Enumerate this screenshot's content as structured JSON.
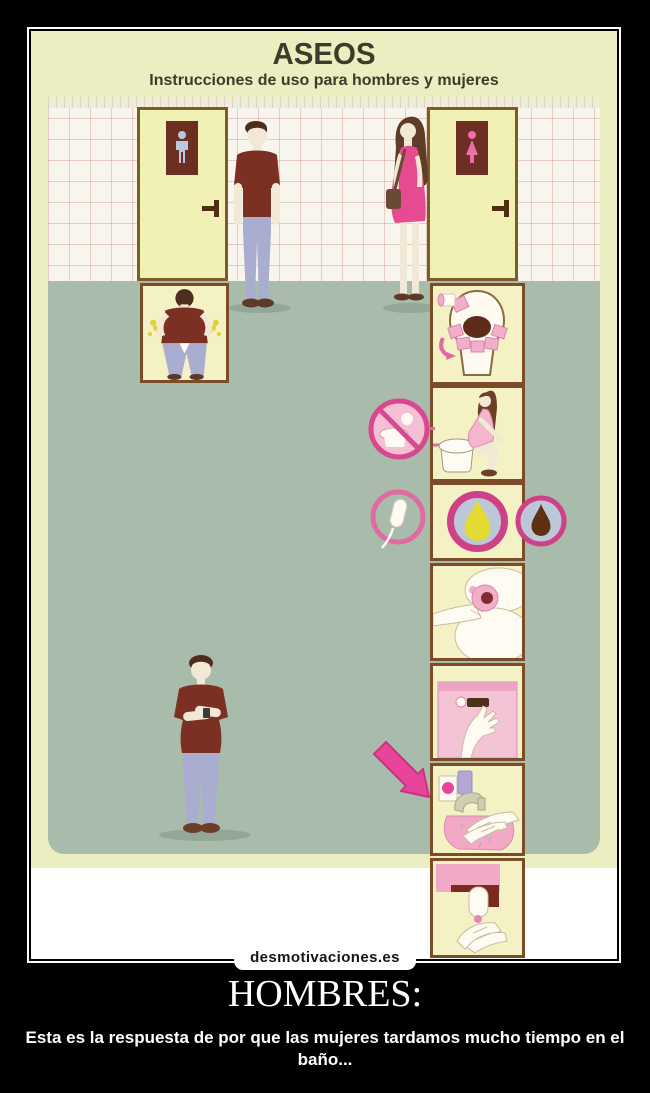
{
  "poster": {
    "title": "ASEOS",
    "subtitle": "Instrucciones de uso para hombres y mujeres"
  },
  "watermark": {
    "label": "desmotivaciones.es"
  },
  "caption": {
    "title": "HOMBRES:",
    "body": "Esta es la respuesta de por que las mujeres tardamos mucho tiempo en el baño..."
  },
  "scene": {
    "doors": [
      {
        "name": "mens-door",
        "sign_icon": "male-figure-icon"
      },
      {
        "name": "womens-door",
        "sign_icon": "female-figure-icon"
      }
    ],
    "men_steps": [
      "pee-standing-at-toilet",
      "check-watch-waiting"
    ],
    "women_steps": [
      "cover-seat-with-paper",
      "hover-over-toilet-without-sitting",
      "pee-drop",
      "wipe-with-paper",
      "flush-toilet",
      "wash-hands",
      "dry-hands"
    ],
    "side_icons": [
      "no-sitting-icon",
      "tampon-icon",
      "poop-drop-icon",
      "pink-arrow-icon"
    ]
  },
  "colors": {
    "poster_bg": "#ebeec1",
    "wall": "#f8f6ec",
    "tile_line": "#d6a0a0",
    "floor": "#a9bcab",
    "door": "#f1f1b6",
    "door_border": "#7c5b2a",
    "sign_plate": "#6e2f23",
    "panel_bg": "#f4f1c4",
    "panel_border": "#7c4b28",
    "shirt_red": "#7c3023",
    "jeans_blue": "#a9aed0",
    "dress_pink": "#e64b92",
    "skin": "#f1e9d6",
    "hair_brown": "#4f2d1d",
    "accent_pink": "#e8459a",
    "ring_pink": "#cf4187",
    "soft_pink": "#f3aec8",
    "pee_yellow": "#e3da33",
    "poop_brown": "#5f3012",
    "circle_fill_blue": "#bcc8d8"
  }
}
